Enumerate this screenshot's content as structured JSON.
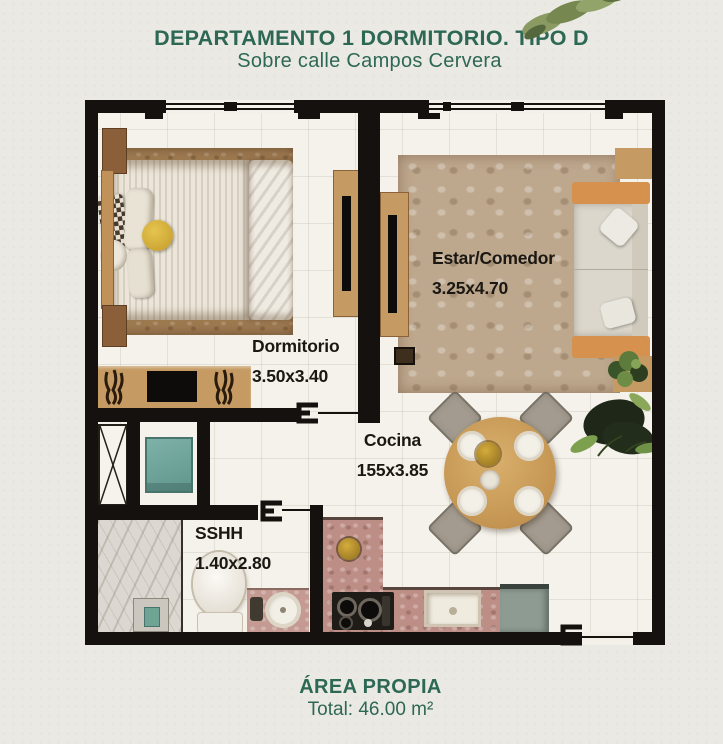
{
  "header": {
    "title": "DEPARTAMENTO 1 DORMITORIO. TIPO D",
    "subtitle": "Sobre calle Campos Cervera"
  },
  "floorplan": {
    "rooms": [
      {
        "id": "estar-comedor",
        "label": "Estar/Comedor",
        "dimensions": "3.25x4.70"
      },
      {
        "id": "dormitorio",
        "label": "Dormitorio",
        "dimensions": "3.50x3.40"
      },
      {
        "id": "cocina",
        "label": "Cocina",
        "dimensions": "155x3.85"
      },
      {
        "id": "sshh",
        "label": "SSHH",
        "dimensions": "1.40x2.80"
      }
    ]
  },
  "footer": {
    "area_title": "ÁREA PROPIA",
    "total": "Total: 46.00 m²"
  },
  "colors": {
    "accent_green": "#2d6854",
    "wall_black": "#15110e",
    "floor": "#f5f2ec",
    "wood": "#c59b63",
    "rug_living": "#bda78d",
    "rug_bedroom": "#9d7950",
    "counter_pink": "#bd8e86",
    "appliance_teal": "#7eb2a8",
    "sofa_orange": "#d6914f",
    "leaf_olive": "#8a9a62"
  },
  "icons": {
    "leaf_decoration": "olive-leaf-branch",
    "door_jamb": "door-frame-symbol",
    "closet_x": "shaft-cross-symbol"
  }
}
